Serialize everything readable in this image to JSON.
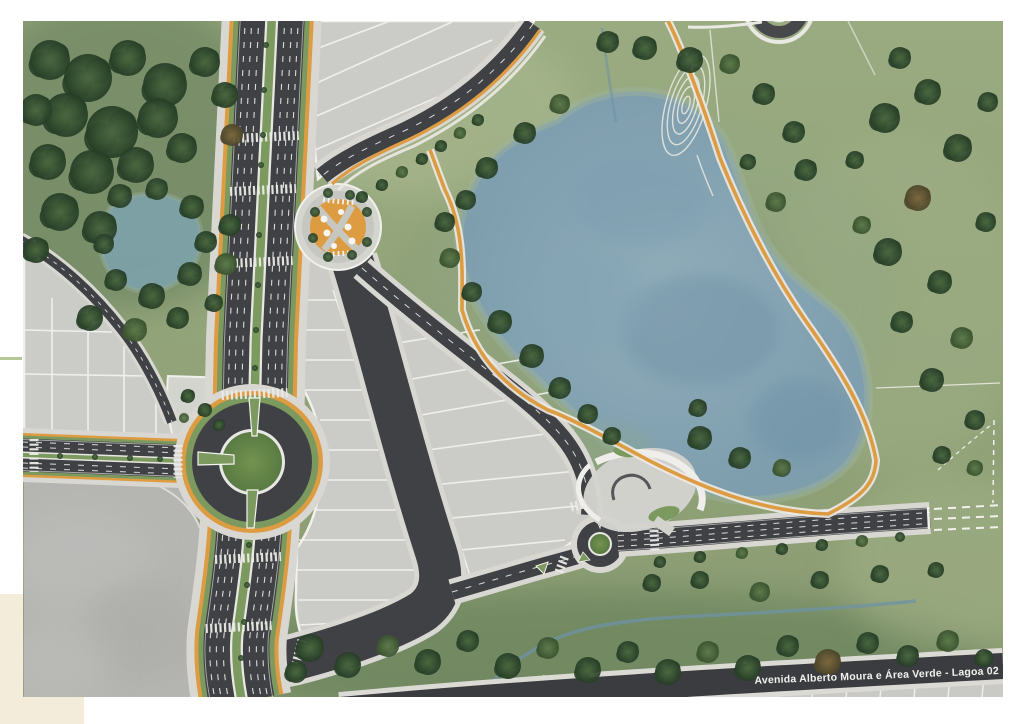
{
  "caption": {
    "text": "Avenida Alberto Moura e Área Verde - Lagoa 02"
  },
  "map": {
    "type": "masterplan-aerial-rendering",
    "features": [
      {
        "id": "avenida-alberto-moura",
        "label": "Avenida Alberto Moura",
        "kind": "dual-carriageway-avenue",
        "color": "#404144"
      },
      {
        "id": "area-verde",
        "label": "Área Verde",
        "kind": "green-park-area",
        "color": "#93a67e"
      },
      {
        "id": "lagoa-02",
        "label": "Lagoa 02",
        "kind": "lake",
        "color": "#8aa8b8"
      },
      {
        "id": "large-roundabout",
        "kind": "roundabout-with-green-island"
      },
      {
        "id": "small-roundabout",
        "kind": "roundabout-with-green-island"
      },
      {
        "id": "central-plaza",
        "kind": "circular-plaza-with-kiosks",
        "color": "#dd9c41"
      },
      {
        "id": "cycle-path",
        "kind": "cycleway-loop-around-lake",
        "color": "#dd9c41"
      },
      {
        "id": "labyrinth-garden",
        "kind": "concentric-path-loops"
      },
      {
        "id": "parcels",
        "kind": "subdivided-lots",
        "color": "#cbcbc7"
      },
      {
        "id": "pond",
        "kind": "small-pond",
        "color": "#7da2ab"
      },
      {
        "id": "stream",
        "kind": "stream",
        "color": "#6e93a6"
      },
      {
        "id": "future-road-extension",
        "kind": "dashed-planned-road"
      }
    ]
  },
  "theme": {
    "page_bg": "#ffffff",
    "corner_swatch": "#f4ecdb",
    "tick_green": "#b5c795",
    "asphalt": "#404144",
    "sidewalk": "#d8d7d2",
    "orange_cycle": "#dd9c41",
    "verge_green": "#7c9a5f",
    "grass": "#93a67e",
    "lake": "#8aa8b8",
    "plot_gray": "#cbcbc7",
    "pad_gray": "#b5b5b2",
    "caption_band": "#3b3c3f",
    "caption_text": "#f1f1ee"
  }
}
